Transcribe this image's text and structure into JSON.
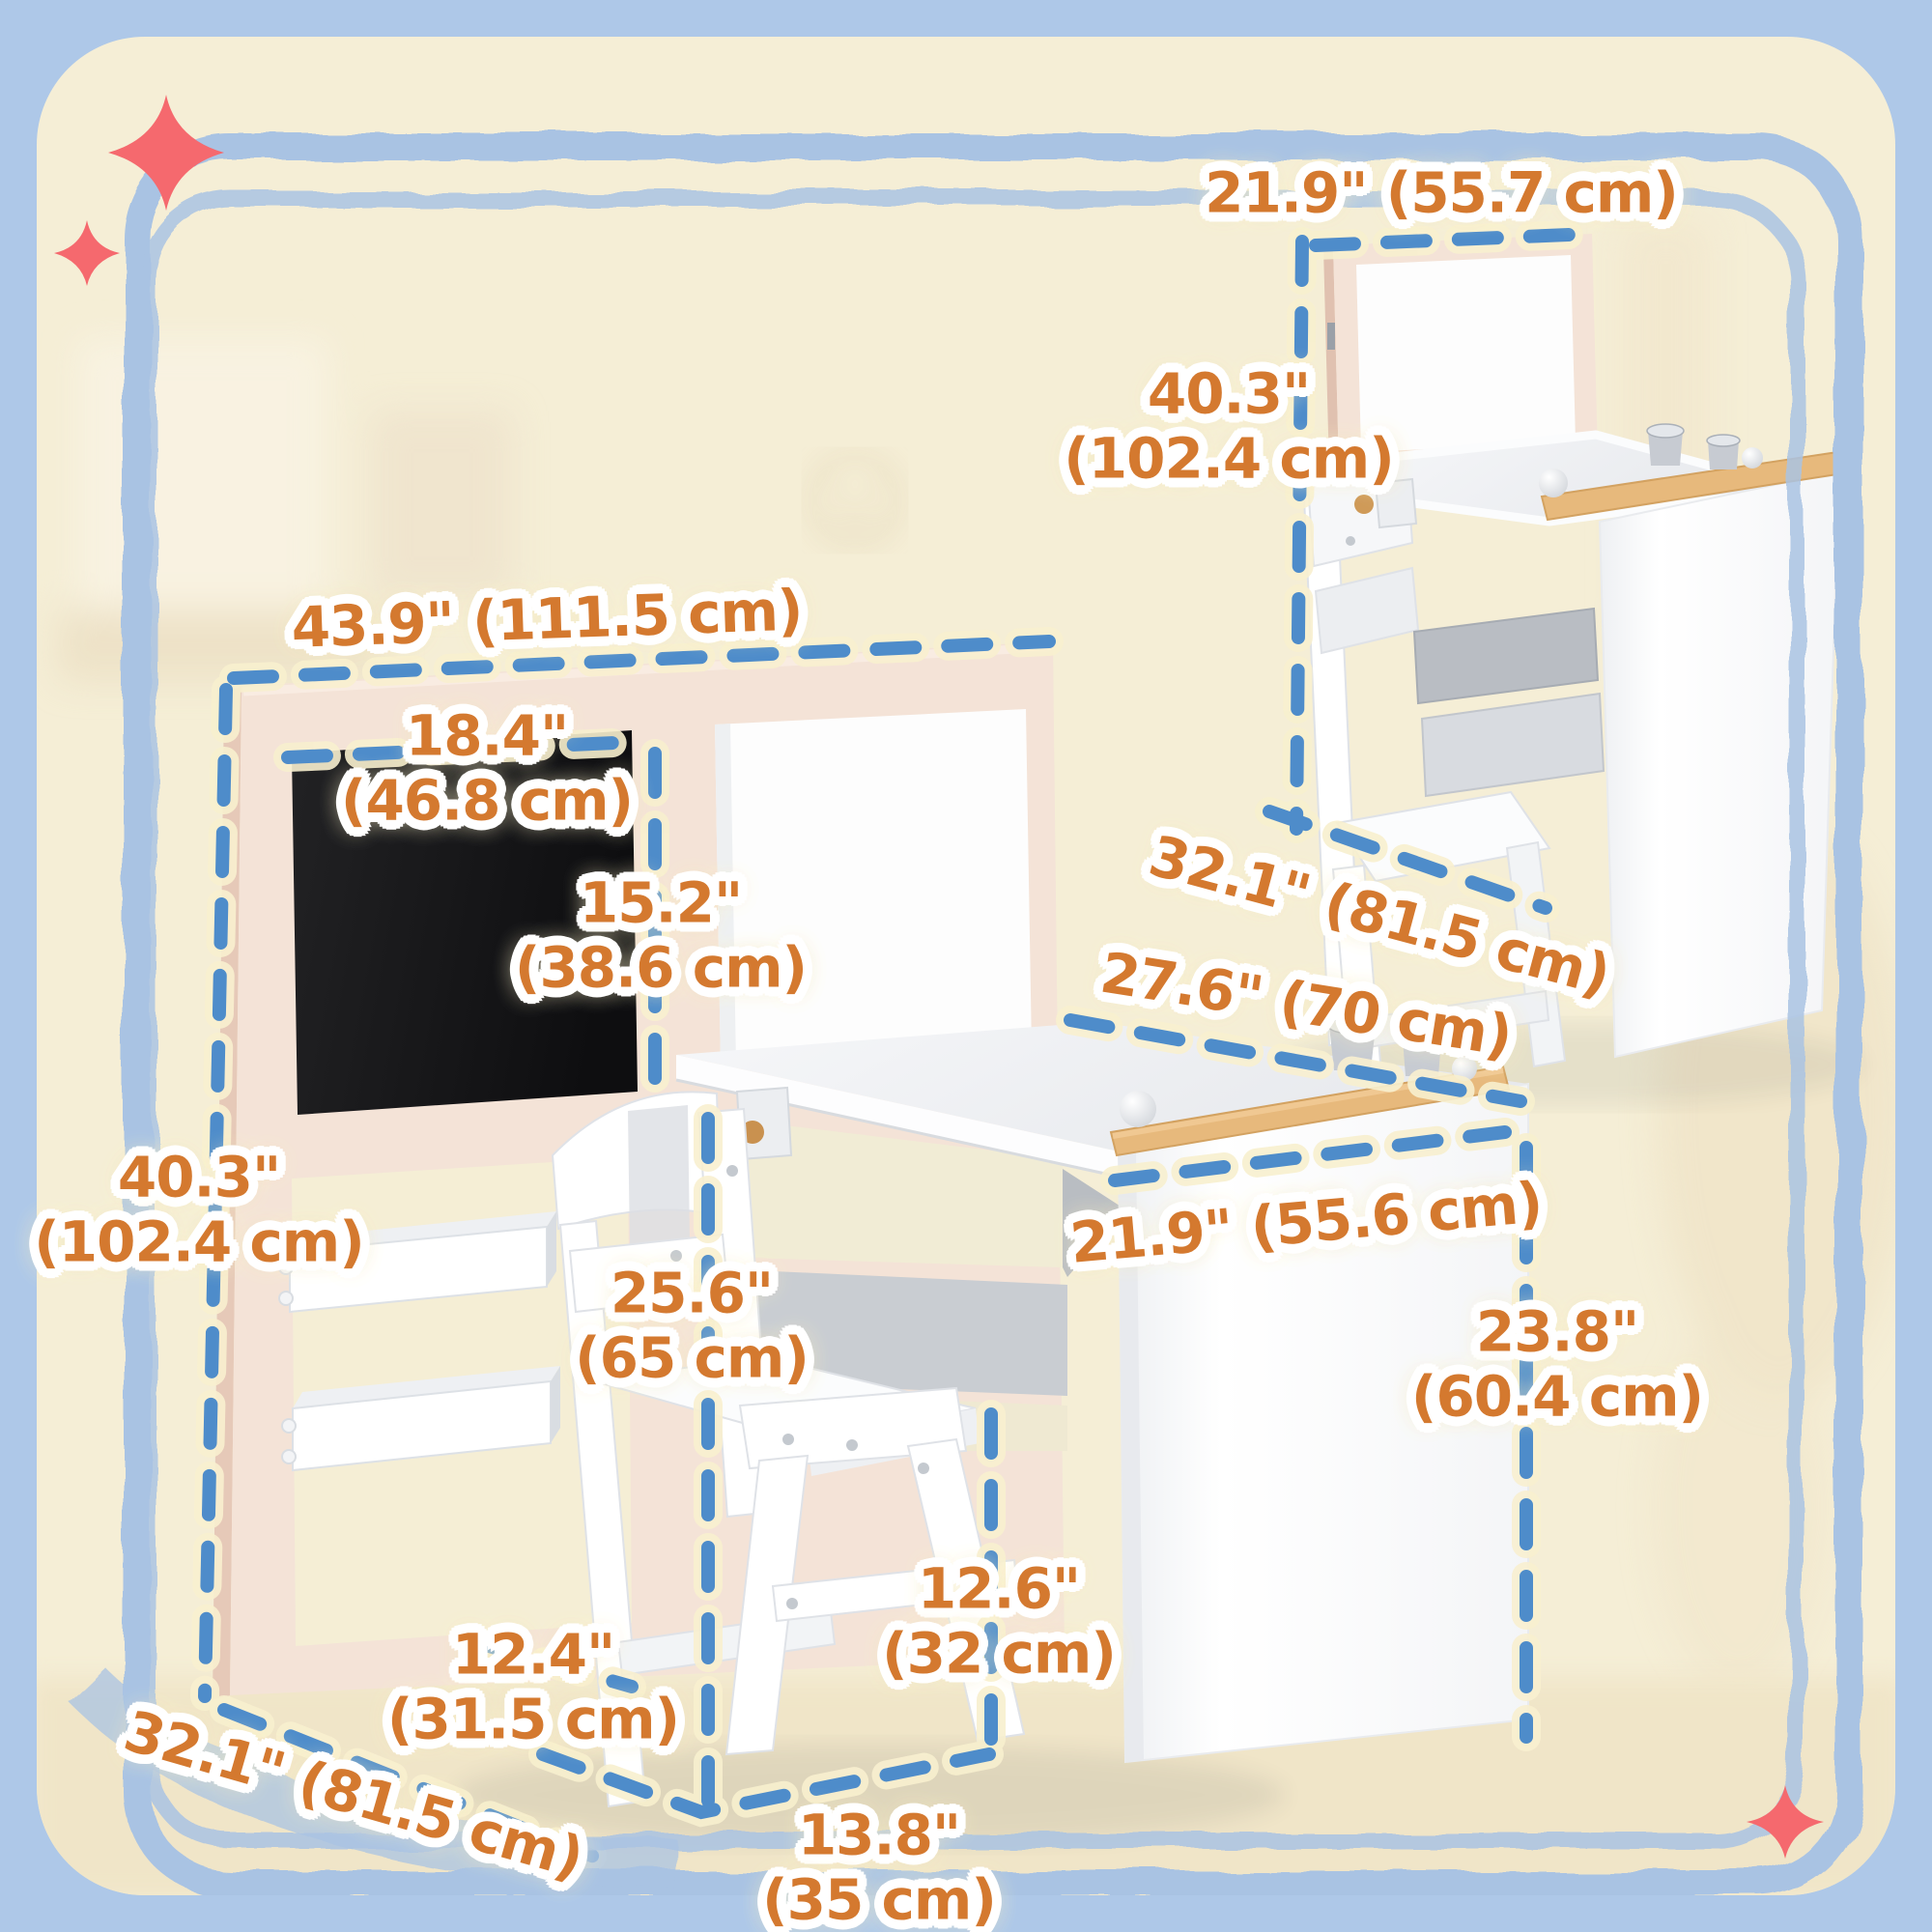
{
  "scene": {
    "kind": "product dimension diagram",
    "product": "kids art desk and chair set with chalkboard and whiteboard easel"
  },
  "colors": {
    "outer_background": "#aec8e8",
    "card_background": "#f5eed6",
    "crayon_border": "#a9c3e3",
    "dimension_dash": "#4e8cca",
    "dimension_halo": "#f8f0cf",
    "label_text": "#d4792f",
    "label_outline": "#ffffff",
    "sparkle": "#f5696e",
    "easel_frame": "#f4e3d7",
    "chalkboard": "#161616",
    "furniture_white": "#ffffff",
    "wood_rail": "#e7b97c",
    "storage_cream": "#f1ecd5",
    "tray_gray": "#c9ccd0"
  },
  "labels": {
    "fold_width": {
      "l1": "21.9\" (55.7 cm)"
    },
    "fold_height": {
      "l1": "40.3\"",
      "l2": "(102.4 cm)"
    },
    "fold_depth": {
      "l1": "32.1\" (81.5 cm)"
    },
    "easel_width": {
      "l1": "43.9\" (111.5 cm)"
    },
    "chalkboard_width": {
      "l1": "18.4\"",
      "l2": "(46.8 cm)"
    },
    "chalkboard_height": {
      "l1": "15.2\"",
      "l2": "(38.6 cm)"
    },
    "easel_height": {
      "l1": "40.3\"",
      "l2": "(102.4 cm)"
    },
    "desktop_depth": {
      "l1": "27.6\" (70 cm)"
    },
    "desktop_width": {
      "l1": "21.9\" (55.6 cm)"
    },
    "chair_height": {
      "l1": "25.6\"",
      "l2": "(65 cm)"
    },
    "desk_height": {
      "l1": "23.8\"",
      "l2": "(60.4 cm)"
    },
    "tray_width": {
      "l1": "12.4\"",
      "l2": "(31.5 cm)"
    },
    "seat_height": {
      "l1": "12.6\"",
      "l2": "(32 cm)"
    },
    "base_depth": {
      "l1": "32.1\" (81.5 cm)"
    },
    "chair_width": {
      "l1": "13.8\"",
      "l2": "(35 cm)"
    }
  },
  "icons": {
    "sparkle_top_left_large": "sparkle-icon",
    "sparkle_top_left_small": "sparkle-icon",
    "sparkle_bottom_right": "sparkle-icon"
  }
}
